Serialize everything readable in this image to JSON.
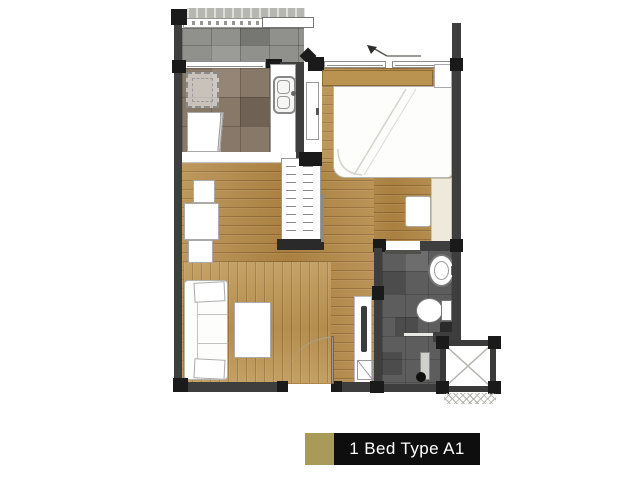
{
  "caption": {
    "text": "1 Bed Type A1",
    "swatch_color": "#a89a58",
    "bar_color": "#0e0e0e",
    "text_color": "#ffffff"
  },
  "floorplan": {
    "type": "apartment-unit-floor-plan",
    "rooms": [
      {
        "id": "balcony"
      },
      {
        "id": "kitchen"
      },
      {
        "id": "foyer"
      },
      {
        "id": "bedroom"
      },
      {
        "id": "wardrobe"
      },
      {
        "id": "living-dining"
      },
      {
        "id": "bathroom"
      },
      {
        "id": "ac-ledge"
      }
    ],
    "colors": {
      "wall": "#3e3e3e",
      "post": "#1a1a1a",
      "wood_floor": "#b28744",
      "wood_floor_light": "#bd9552",
      "kitchen_tile": "#887868",
      "balcony_tile": "#90908c",
      "bath_tile": "#5d5d5d"
    }
  }
}
